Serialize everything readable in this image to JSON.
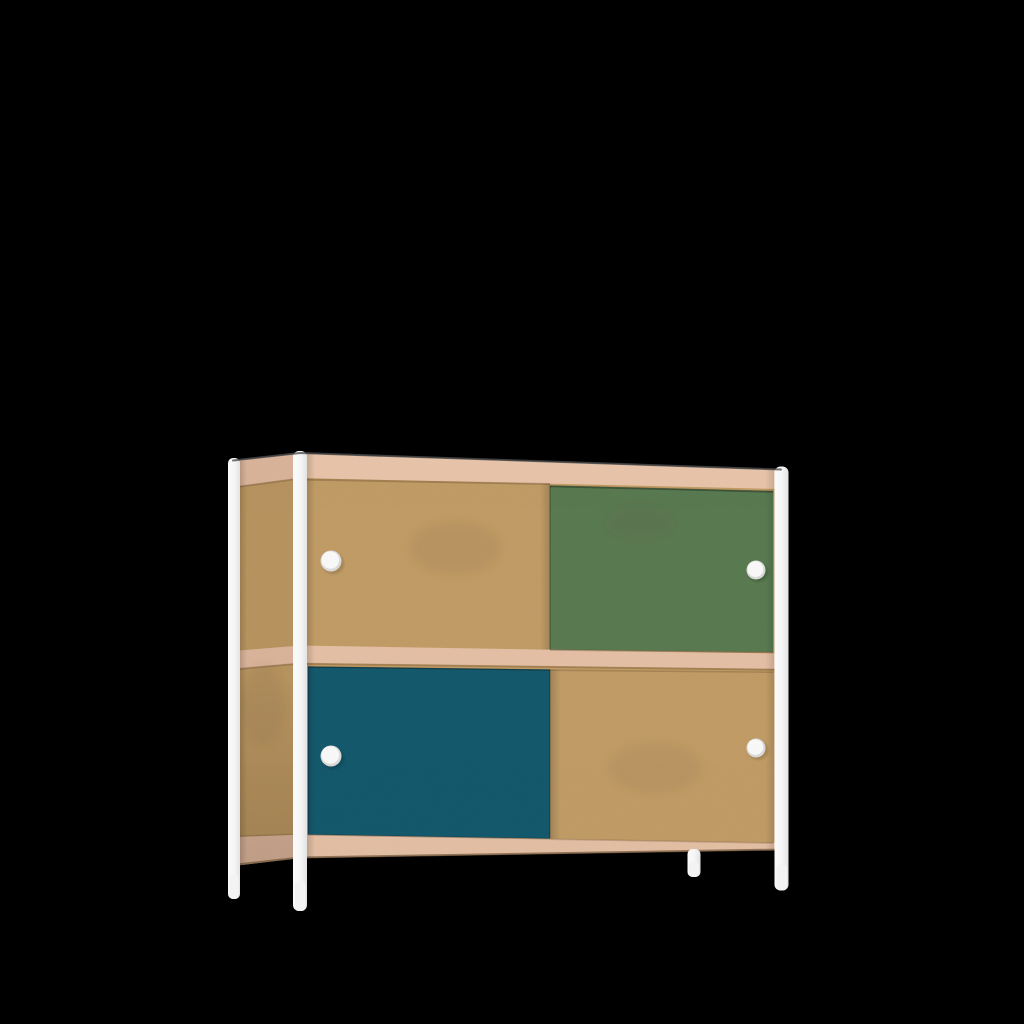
{
  "scene": {
    "type": "3d-product-render",
    "object": "two-tier sideboard cabinet with sliding doors on a white tubular steel frame",
    "background_color": "#000000"
  },
  "product": {
    "frame": "white steel posts and four legs",
    "body": "mdf panels with rose plywood edge bands",
    "top_row_doors": [
      "mdf",
      "green"
    ],
    "bottom_row_doors": [
      "blue",
      "mdf"
    ],
    "knob_count": 4,
    "knob_style": "round white"
  },
  "colors": {
    "background": "#000000",
    "mdf_front": "#c19c66",
    "mdf_side": "#b7935f",
    "band_top_front": "#e9c5ab",
    "band_shelf_front": "#e5c0a6",
    "band_bottom_front": "#e4c0a5",
    "band_side": "#dab49b",
    "door_green": "#587a51",
    "door_blue": "#12586d",
    "frame_white": "#fbfbfb",
    "frame_shade": "#e3e3e3",
    "foot_white": "#f3f3f3",
    "knob_rim": "#dcdcdc",
    "knob_face": "#fbfbfb",
    "edge_line": "#4d4d4d",
    "under_edge": "#6f553a"
  }
}
